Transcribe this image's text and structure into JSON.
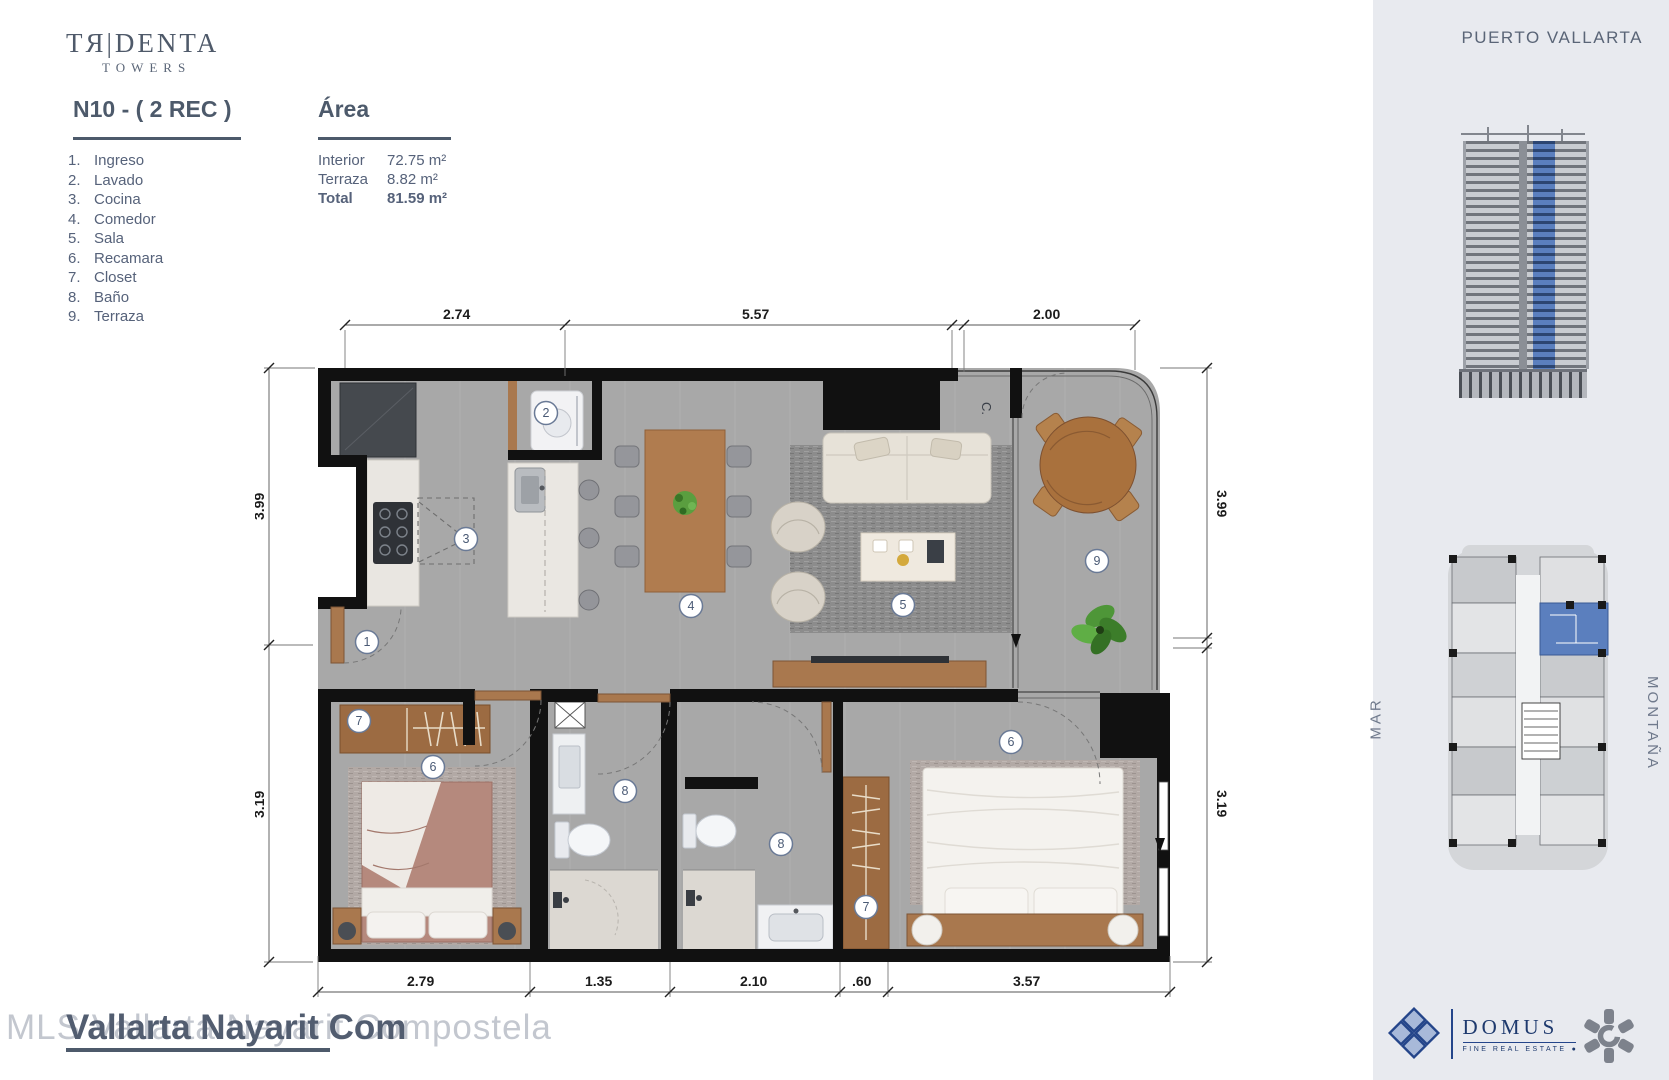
{
  "brand": {
    "name": "TЯ|DENTA",
    "sub": "TOWERS"
  },
  "unit_title": "N10 - ( 2 REC )",
  "legend": [
    {
      "num": "1.",
      "label": "Ingreso"
    },
    {
      "num": "2.",
      "label": "Lavado"
    },
    {
      "num": "3.",
      "label": "Cocina"
    },
    {
      "num": "4.",
      "label": "Comedor"
    },
    {
      "num": "5.",
      "label": "Sala"
    },
    {
      "num": "6.",
      "label": "Recamara"
    },
    {
      "num": "7.",
      "label": "Closet"
    },
    {
      "num": "8.",
      "label": "Baño"
    },
    {
      "num": "9.",
      "label": "Terraza"
    }
  ],
  "area": {
    "title": "Área",
    "rows": [
      {
        "label": "Interior",
        "value": "72.75 m²"
      },
      {
        "label": "Terraza",
        "value": "8.82 m²"
      },
      {
        "label": "Total",
        "value": "81.59 m²"
      }
    ]
  },
  "plan": {
    "dims_top": [
      "2.74",
      "5.57",
      "2.00"
    ],
    "dims_bottom": [
      "2.79",
      "1.35",
      "2.10",
      ".60",
      "3.57"
    ],
    "dims_left": [
      "3.99",
      "3.19"
    ],
    "dims_right": [
      "3.99",
      "3.19"
    ],
    "closet_c": "C.",
    "markers": {
      "entry": "1",
      "laundry": "2",
      "kitchen": "3",
      "dining": "4",
      "living": "5",
      "bed1": "6",
      "closet1": "7",
      "bath1": "8",
      "bath2": "8",
      "closet2": "7",
      "bed2": "6",
      "terrace": "9"
    }
  },
  "sidebar": {
    "location": "PUERTO VALLARTA",
    "label_sea": "MAR",
    "label_mountain": "MONTAÑA",
    "domus_name": "DOMUS",
    "domus_tagline": "FINE REAL ESTATE"
  },
  "watermark": {
    "light": "MLS Vallarta Nayarit Compostela",
    "dark": "Vallarta Nayarit Com"
  },
  "colors": {
    "accent_blue": "#5b7fbe",
    "slate": "#4d5a6b",
    "domus_blue": "#1e3a6e",
    "wall": "#111111",
    "wood": "#a9784e"
  }
}
